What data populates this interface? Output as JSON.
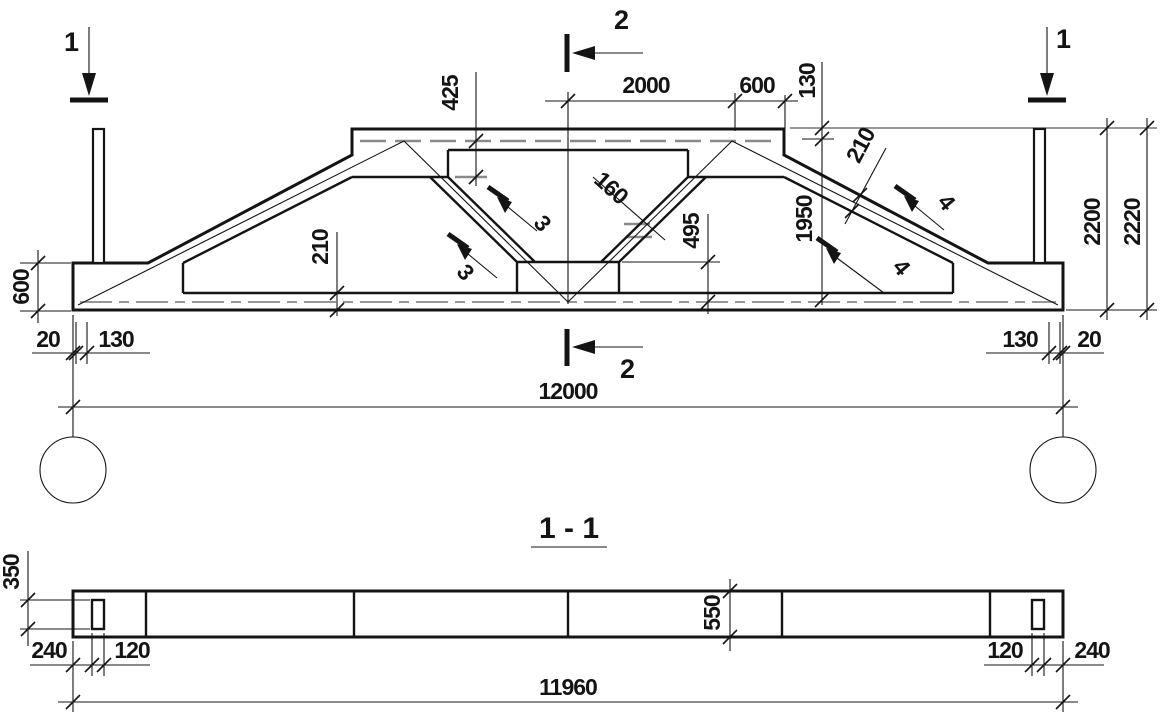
{
  "drawing": {
    "colors": {
      "line": "#141414",
      "axis_gray": "#8a8a8a",
      "background": "#ffffff"
    },
    "cut_marks": {
      "one": "1",
      "two": "2",
      "three": "3",
      "four": "4"
    },
    "elevation": {
      "dims": {
        "top_offset": "425",
        "half_top": "2000",
        "top_end": "600",
        "flange": "130",
        "strut_width": "160",
        "slope_chord_width": "210",
        "inner_height": "1950",
        "center_web": "495",
        "bottom_chord": "210",
        "end_height": "600",
        "support_gap": "20",
        "support_edge": "130",
        "span": "12000",
        "height": "2200",
        "height_total": "2220"
      }
    },
    "section": {
      "title": "1 - 1",
      "dims": {
        "slot_height": "350",
        "depth": "550",
        "slot_edge": "240",
        "slot_width": "120",
        "length": "11960"
      }
    }
  }
}
